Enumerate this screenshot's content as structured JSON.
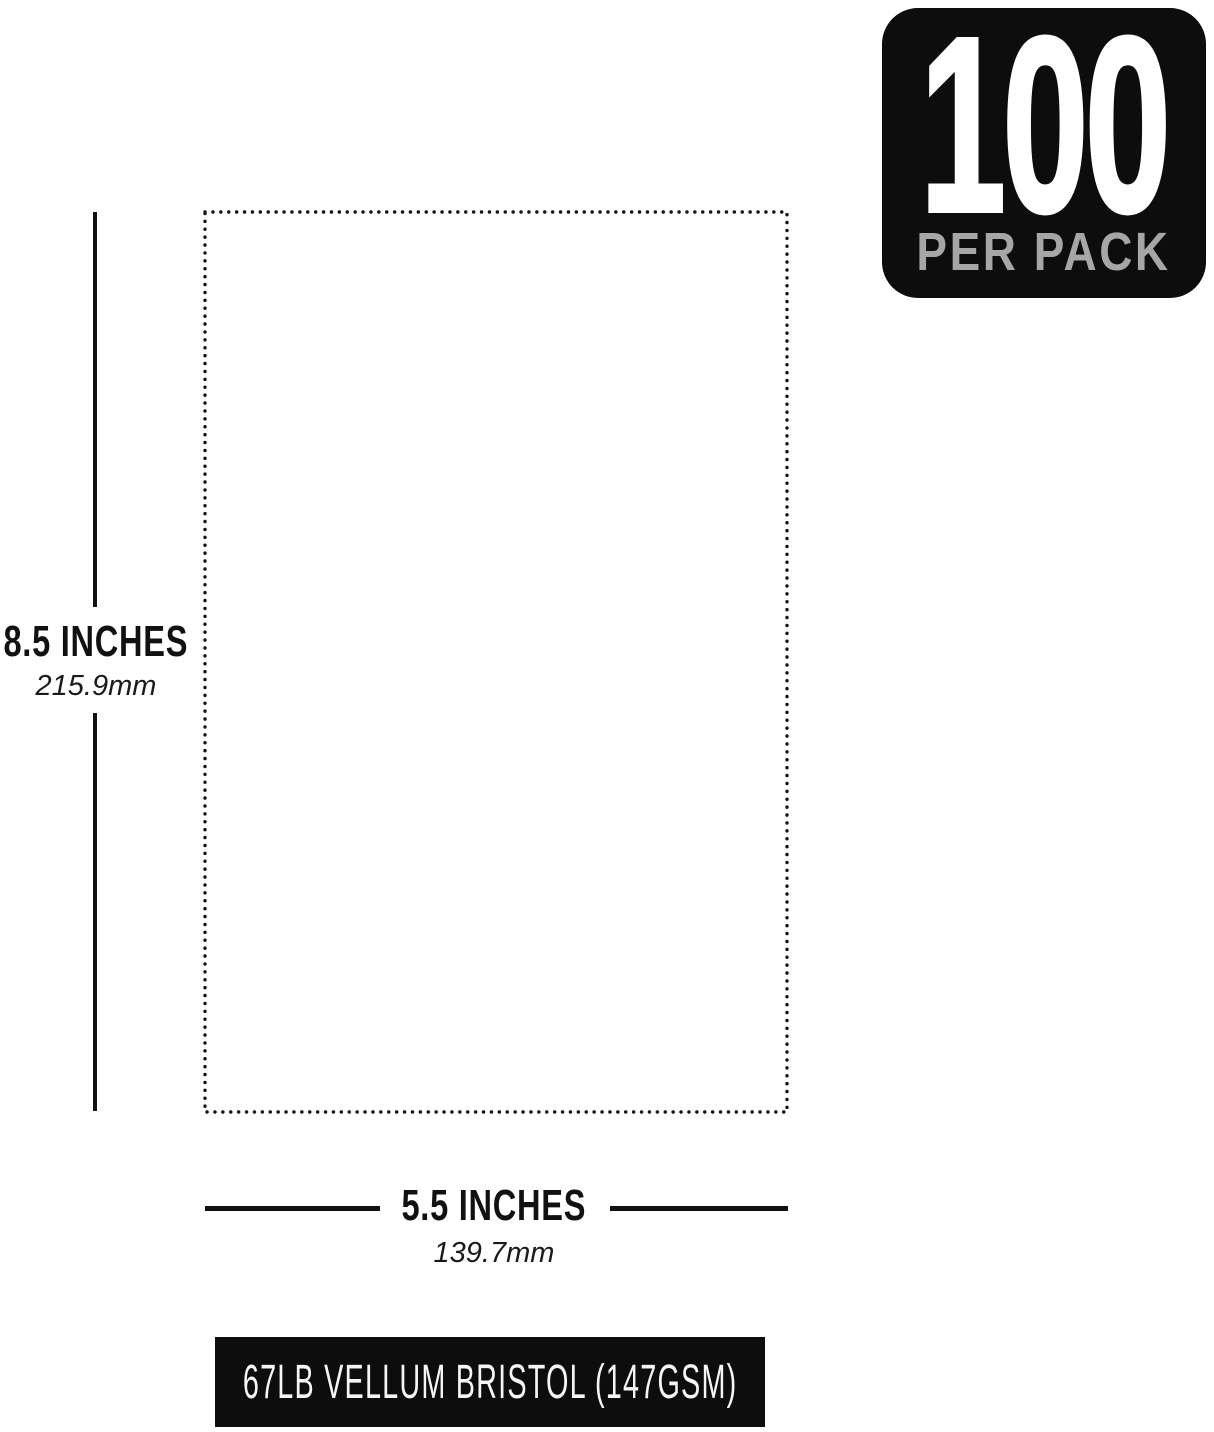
{
  "badge": {
    "count": "100",
    "label": "PER PACK"
  },
  "paper": {
    "outline_style": "dotted rectangle",
    "height_inches_label": "8.5 INCHES",
    "height_mm_label": "215.9mm",
    "width_inches_label": "5.5 INCHES",
    "width_mm_label": "139.7mm"
  },
  "banner": {
    "text": "67LB VELLUM BRISTOL (147GSM)"
  },
  "colors": {
    "ink": "#111111",
    "badge_bg": "#0d0d0d",
    "badge_label_gray": "#a6a6a6",
    "banner_bg": "#0d0d0d",
    "banner_text": "#f5f5f5",
    "background": "#ffffff"
  }
}
